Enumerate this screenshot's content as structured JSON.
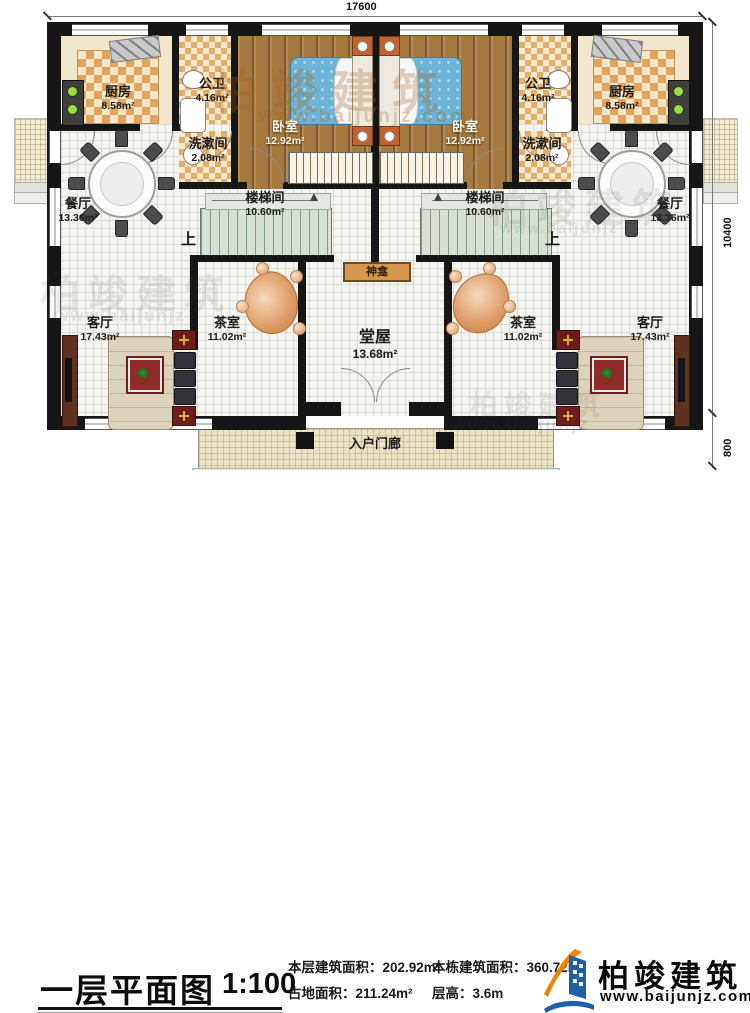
{
  "dimensions": {
    "top": "17600",
    "right_main": "10400",
    "right_porch": "800"
  },
  "stair": {
    "up_left": "上",
    "up_right": "上"
  },
  "rooms": {
    "kitchen_l": {
      "name": "厨房",
      "area": "8.58m²"
    },
    "kitchen_r": {
      "name": "厨房",
      "area": "8.58m²"
    },
    "bath_l": {
      "name": "公卫",
      "area": "4.16m²"
    },
    "bath_r": {
      "name": "公卫",
      "area": "4.16m²"
    },
    "wash_l": {
      "name": "洗漱间",
      "area": "2.08m²"
    },
    "wash_r": {
      "name": "洗漱间",
      "area": "2.08m²"
    },
    "bedroom_l": {
      "name": "卧室",
      "area": "12.92m²"
    },
    "bedroom_r": {
      "name": "卧室",
      "area": "12.92m²"
    },
    "dining_l": {
      "name": "餐厅",
      "area": "13.36m²"
    },
    "dining_r": {
      "name": "餐厅",
      "area": "13.36m²"
    },
    "stairwell_l": {
      "name": "楼梯间",
      "area": "10.60m²"
    },
    "stairwell_r": {
      "name": "楼梯间",
      "area": "10.60m²"
    },
    "living_l": {
      "name": "客厅",
      "area": "17.43m²"
    },
    "living_r": {
      "name": "客厅",
      "area": "17.43m²"
    },
    "tea_l": {
      "name": "茶室",
      "area": "11.02m²"
    },
    "tea_r": {
      "name": "茶室",
      "area": "11.02m²"
    },
    "hall": {
      "name": "堂屋",
      "area": "13.68m²"
    },
    "shrine": {
      "name": "神龛"
    },
    "porch": {
      "name": "入户门廊"
    }
  },
  "watermarks": {
    "brand": "柏竣建筑",
    "url": "www.baijunjz.com",
    "url_short": "www.baijunjz"
  },
  "footer": {
    "title": "一层平面图",
    "scale": "1:100",
    "stats": [
      {
        "label": "本层建筑面积：",
        "value": "202.92m²"
      },
      {
        "label": "占地面积：",
        "value": "211.24m²"
      },
      {
        "label": "本栋建筑面积：",
        "value": "360.72m²"
      },
      {
        "label": "层高：",
        "value": "3.6m"
      }
    ],
    "brand": "柏竣建筑",
    "brand_url": "www.baijunjz.com"
  }
}
